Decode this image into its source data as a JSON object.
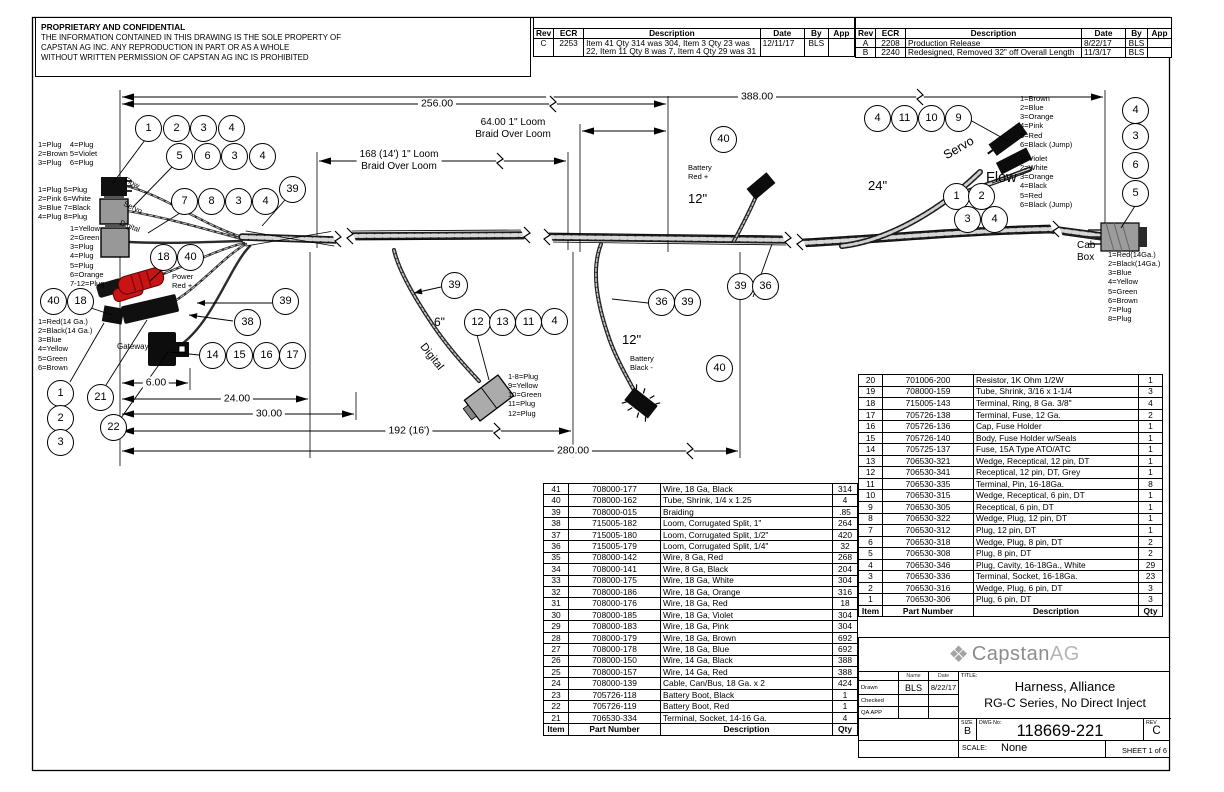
{
  "notice": {
    "title": "PROPRIETARY AND CONFIDENTIAL",
    "line1": "THE INFORMATION CONTAINED IN THIS DRAWING IS THE SOLE PROPERTY OF",
    "line2": "CAPSTAN AG INC. ANY REPRODUCTION IN PART OR AS A WHOLE",
    "line3": "WITHOUT WRITTEN PERMISSION OF CAPSTAN AG INC IS PROHIBITED"
  },
  "rev_table_left": {
    "headers": [
      "Rev",
      "ECR",
      "Description",
      "Date",
      "By",
      "App"
    ],
    "rows": [
      [
        "C",
        "2253",
        "Item 41 Qty 314 was 304, Item 3 Qty 23 was 22, Item 11 Qty 8 was 7, Item 4 Qty 29 was 31",
        "12/11/17",
        "BLS",
        ""
      ]
    ]
  },
  "rev_table_right": {
    "headers": [
      "Rev",
      "ECR",
      "Description",
      "Date",
      "By",
      "App"
    ],
    "rows": [
      [
        "A",
        "2208",
        "Production Release",
        "8/22/17",
        "BLS",
        ""
      ],
      [
        "B",
        "2240",
        "Redesigned, Removed 32\" off Overall Length",
        "11/3/17",
        "BLS",
        ""
      ]
    ]
  },
  "bom_left": {
    "headers": [
      "Item",
      "Part Number",
      "Description",
      "Qty"
    ],
    "rows": [
      [
        "41",
        "708000-177",
        "Wire, 18 Ga, Black",
        "314"
      ],
      [
        "40",
        "708000-162",
        "Tube, Shrink, 1/4 x 1.25",
        "4"
      ],
      [
        "39",
        "708000-015",
        "Braiding",
        ".85"
      ],
      [
        "38",
        "715005-182",
        "Loom, Corrugated Split, 1\"",
        "264"
      ],
      [
        "37",
        "715005-180",
        "Loom, Corrugated Split, 1/2\"",
        "420"
      ],
      [
        "36",
        "715005-179",
        "Loom, Corrugated Split, 1/4\"",
        "32"
      ],
      [
        "35",
        "708000-142",
        "Wire, 8 Ga, Red",
        "268"
      ],
      [
        "34",
        "708000-141",
        "Wire, 8 Ga, Black",
        "204"
      ],
      [
        "33",
        "708000-175",
        "Wire, 18 Ga, White",
        "304"
      ],
      [
        "32",
        "708000-186",
        "Wire, 18 Ga, Orange",
        "316"
      ],
      [
        "31",
        "708000-176",
        "Wire, 18 Ga, Red",
        "18"
      ],
      [
        "30",
        "708000-185",
        "Wire, 18 Ga, Violet",
        "304"
      ],
      [
        "29",
        "708000-183",
        "Wire, 18 Ga, Pink",
        "304"
      ],
      [
        "28",
        "708000-179",
        "Wire, 18 Ga, Brown",
        "692"
      ],
      [
        "27",
        "708000-178",
        "Wire, 18 Ga, Blue",
        "692"
      ],
      [
        "26",
        "708000-150",
        "Wire, 14 Ga, Black",
        "388"
      ],
      [
        "25",
        "708000-157",
        "Wire, 14 Ga, Red",
        "388"
      ],
      [
        "24",
        "708000-139",
        "Cable, Can/Bus, 18 Ga. x 2",
        "424"
      ],
      [
        "23",
        "705726-118",
        "Battery Boot, Black",
        "1"
      ],
      [
        "22",
        "705726-119",
        "Battery Boot, Red",
        "1"
      ],
      [
        "21",
        "706530-334",
        "Terminal, Socket, 14-16 Ga.",
        "4"
      ]
    ]
  },
  "bom_right": {
    "headers": [
      "Item",
      "Part Number",
      "Description",
      "Qty"
    ],
    "rows": [
      [
        "20",
        "701006-200",
        "Resistor, 1K Ohm 1/2W",
        "1"
      ],
      [
        "19",
        "708000-159",
        "Tube, Shrink, 3/16 x 1-1/4",
        "3"
      ],
      [
        "18",
        "715005-143",
        "Terminal, Ring, 8 Ga. 3/8\"",
        "4"
      ],
      [
        "17",
        "705726-138",
        "Terminal, Fuse, 12 Ga.",
        "2"
      ],
      [
        "16",
        "705726-136",
        "Cap, Fuse Holder",
        "1"
      ],
      [
        "15",
        "705726-140",
        "Body, Fuse Holder w/Seals",
        "1"
      ],
      [
        "14",
        "705725-137",
        "Fuse, 15A Type ATO/ATC",
        "1"
      ],
      [
        "13",
        "706530-321",
        "Wedge, Receptical, 12 pin, DT",
        "1"
      ],
      [
        "12",
        "706530-341",
        "Receptical, 12 pin, DT, Grey",
        "1"
      ],
      [
        "11",
        "706530-335",
        "Terminal, Pin, 16-18Ga.",
        "8"
      ],
      [
        "10",
        "706530-315",
        "Wedge, Receptical, 6 pin, DT",
        "1"
      ],
      [
        "9",
        "706530-305",
        "Receptical, 6 pin, DT",
        "1"
      ],
      [
        "8",
        "706530-322",
        "Wedge, Plug, 12 pin, DT",
        "1"
      ],
      [
        "7",
        "706530-312",
        "Plug, 12 pin, DT",
        "1"
      ],
      [
        "6",
        "706530-318",
        "Wedge, Plug, 8 pin, DT",
        "2"
      ],
      [
        "5",
        "706530-308",
        "Plug, 8 pin, DT",
        "2"
      ],
      [
        "4",
        "706530-346",
        "Plug, Cavity, 16-18Ga., White",
        "29"
      ],
      [
        "3",
        "706530-336",
        "Terminal, Socket, 16-18Ga.",
        "23"
      ],
      [
        "2",
        "706530-316",
        "Wedge, Plug, 6 pin, DT",
        "3"
      ],
      [
        "1",
        "706530-306",
        "Plug, 6 pin, DT",
        "3"
      ]
    ]
  },
  "title_block": {
    "company_prefix": "Capstan",
    "company_suffix": "AG",
    "logo_icon": "diamond-checker-icon",
    "name_col": "Name",
    "date_col": "Date",
    "drawn_label": "Drawn",
    "checked_label": "Checked",
    "qa_label": "QA APP",
    "drawn_by": "BLS",
    "drawn_date": "8/22/17",
    "title_label": "TITLE:",
    "title1": "Harness, Alliance",
    "title2": "RG-C Series, No Direct Inject",
    "size_label": "SIZE",
    "size": "B",
    "dwg_label": "DWG No:",
    "dwg_no": "118669-221",
    "rev_label": "REV",
    "rev": "C",
    "scale_label": "SCALE:",
    "scale": "None",
    "sheet": "SHEET 1 of 6"
  },
  "balloons": [
    {
      "n": "1",
      "x": 148,
      "y": 128
    },
    {
      "n": "2",
      "x": 176,
      "y": 128
    },
    {
      "n": "3",
      "x": 203,
      "y": 128
    },
    {
      "n": "4",
      "x": 231,
      "y": 128
    },
    {
      "n": "5",
      "x": 179,
      "y": 156
    },
    {
      "n": "6",
      "x": 207,
      "y": 156
    },
    {
      "n": "3",
      "x": 234,
      "y": 156
    },
    {
      "n": "4",
      "x": 262,
      "y": 156
    },
    {
      "n": "7",
      "x": 184,
      "y": 201
    },
    {
      "n": "8",
      "x": 211,
      "y": 201
    },
    {
      "n": "3",
      "x": 238,
      "y": 201
    },
    {
      "n": "4",
      "x": 265,
      "y": 201
    },
    {
      "n": "39",
      "x": 292,
      "y": 189
    },
    {
      "n": "18",
      "x": 163,
      "y": 257
    },
    {
      "n": "40",
      "x": 190,
      "y": 257
    },
    {
      "n": "40",
      "x": 53,
      "y": 301
    },
    {
      "n": "18",
      "x": 80,
      "y": 301
    },
    {
      "n": "39",
      "x": 285,
      "y": 301
    },
    {
      "n": "38",
      "x": 247,
      "y": 322
    },
    {
      "n": "14",
      "x": 212,
      "y": 355
    },
    {
      "n": "15",
      "x": 239,
      "y": 355
    },
    {
      "n": "16",
      "x": 266,
      "y": 355
    },
    {
      "n": "17",
      "x": 292,
      "y": 355
    },
    {
      "n": "1",
      "x": 60,
      "y": 393
    },
    {
      "n": "21",
      "x": 100,
      "y": 397
    },
    {
      "n": "2",
      "x": 60,
      "y": 418
    },
    {
      "n": "22",
      "x": 113,
      "y": 427
    },
    {
      "n": "3",
      "x": 60,
      "y": 442
    },
    {
      "n": "39",
      "x": 454,
      "y": 285
    },
    {
      "n": "12",
      "x": 477,
      "y": 322
    },
    {
      "n": "13",
      "x": 502,
      "y": 322
    },
    {
      "n": "11",
      "x": 528,
      "y": 322
    },
    {
      "n": "4",
      "x": 554,
      "y": 321
    },
    {
      "n": "36",
      "x": 661,
      "y": 302
    },
    {
      "n": "39",
      "x": 687,
      "y": 302
    },
    {
      "n": "39",
      "x": 740,
      "y": 286
    },
    {
      "n": "36",
      "x": 765,
      "y": 286
    },
    {
      "n": "40",
      "x": 719,
      "y": 368
    },
    {
      "n": "40",
      "x": 723,
      "y": 139
    },
    {
      "n": "4",
      "x": 877,
      "y": 118
    },
    {
      "n": "11",
      "x": 904,
      "y": 118
    },
    {
      "n": "10",
      "x": 931,
      "y": 118
    },
    {
      "n": "9",
      "x": 958,
      "y": 118
    },
    {
      "n": "1",
      "x": 956,
      "y": 196
    },
    {
      "n": "2",
      "x": 981,
      "y": 196
    },
    {
      "n": "3",
      "x": 967,
      "y": 219
    },
    {
      "n": "4",
      "x": 994,
      "y": 219
    },
    {
      "n": "4",
      "x": 1135,
      "y": 110
    },
    {
      "n": "3",
      "x": 1135,
      "y": 136
    },
    {
      "n": "6",
      "x": 1135,
      "y": 165
    },
    {
      "n": "5",
      "x": 1135,
      "y": 193
    }
  ],
  "labels": [
    {
      "name": "pin-table-flow-left",
      "t": "1=Plug    4=Plug\n2=Brown 5=Violet\n3=Plug    6=Plug",
      "x": 38,
      "y": 140,
      "fs": 7.5
    },
    {
      "name": "pin-table-servo-left",
      "t": "1=Plug 5=Plug\n2=Pink 6=White\n3=Blue 7=Black\n4=Plug 8=Plug",
      "x": 38,
      "y": 185,
      "fs": 7.5
    },
    {
      "name": "pin-table-digital-left",
      "t": "1=Yellow\n2=Green\n3=Plug\n4=Plug\n5=Plug\n6=Orange\n7-12=Plug",
      "x": 70,
      "y": 224,
      "fs": 7.5
    },
    {
      "name": "pin-table-power-left",
      "t": "1=Red(14 Ga.)\n2=Black(14 Ga.)\n3=Blue\n4=Yellow\n5=Green\n6=Brown",
      "x": 38,
      "y": 317,
      "fs": 7.5
    },
    {
      "name": "label-gateway",
      "t": "Gateway",
      "x": 117,
      "y": 342,
      "fs": 8
    },
    {
      "name": "label-power-red",
      "t": "Power\nRed +",
      "x": 172,
      "y": 272,
      "fs": 7.5
    },
    {
      "name": "label-flow-cable",
      "t": "Flow",
      "x": 127,
      "y": 175,
      "fs": 7.5,
      "rot": 27
    },
    {
      "name": "label-servo-cable",
      "t": "Servo",
      "x": 126,
      "y": 199,
      "fs": 7.5,
      "rot": 25
    },
    {
      "name": "label-digital-cable",
      "t": "Digital",
      "x": 122,
      "y": 218,
      "fs": 7.5,
      "rot": 22
    },
    {
      "name": "label-6in",
      "t": "6\"",
      "x": 434,
      "y": 315,
      "fs": 12
    },
    {
      "name": "label-digital-branch",
      "t": "Digital",
      "x": 427,
      "y": 341,
      "fs": 11,
      "rot": 52
    },
    {
      "name": "pin-table-digital-conn",
      "t": "1-8=Plug\n9=Yellow\n10=Green\n11=Plug\n12=Plug",
      "x": 508,
      "y": 372,
      "fs": 7.5
    },
    {
      "name": "label-12in-black",
      "t": "12\"",
      "x": 622,
      "y": 332,
      "fs": 13
    },
    {
      "name": "label-battery-black",
      "t": "Battery\nBlack -",
      "x": 630,
      "y": 354,
      "fs": 7.5
    },
    {
      "name": "label-battery-red",
      "t": "Battery\nRed +",
      "x": 688,
      "y": 163,
      "fs": 7.5
    },
    {
      "name": "label-12in-red",
      "t": "12\"",
      "x": 688,
      "y": 191,
      "fs": 13
    },
    {
      "name": "label-24in",
      "t": "24\"",
      "x": 868,
      "y": 178,
      "fs": 13
    },
    {
      "name": "label-servo-branch",
      "t": "Servo",
      "x": 941,
      "y": 150,
      "fs": 12.5,
      "rot": -30
    },
    {
      "name": "label-flow-branch",
      "t": "Flow",
      "x": 986,
      "y": 170,
      "fs": 14.5
    },
    {
      "name": "pin-table-servo-conn",
      "t": "1=Brown\n2=Blue\n3=Orange\n4=Pink\n5=Red\n6=Black (Jump)",
      "x": 1020,
      "y": 94,
      "fs": 7.5
    },
    {
      "name": "pin-table-flow-conn",
      "t": "1=Violet\n2=White\n3=Orange\n4=Black\n5=Red\n6=Black (Jump)",
      "x": 1020,
      "y": 154,
      "fs": 7.5
    },
    {
      "name": "label-cab-box",
      "t": "Cab\nBox",
      "x": 1077,
      "y": 240,
      "fs": 10
    },
    {
      "name": "pin-table-cab",
      "t": "1=Red(14Ga.)\n2=Black(14Ga.)\n3=Blue\n4=Yellow\n5=Green\n6=Brown\n7=Plug\n8=Plug",
      "x": 1108,
      "y": 250,
      "fs": 7.5
    },
    {
      "name": "dim-388",
      "t": "388.00",
      "x": 757,
      "y": 97,
      "fs": 10.5,
      "ctr": true,
      "bg": true
    },
    {
      "name": "dim-256",
      "t": "256.00",
      "x": 437,
      "y": 104,
      "fs": 10.5,
      "ctr": true,
      "bg": true
    },
    {
      "name": "dim-64-loom",
      "t": "64.00 1\" Loom\nBraid Over Loom",
      "x": 513,
      "y": 129,
      "fs": 10,
      "ctr": true,
      "bg": true
    },
    {
      "name": "dim-168-loom",
      "t": "168 (14') 1\" Loom\nBraid Over Loom",
      "x": 399,
      "y": 161,
      "fs": 10,
      "ctr": true,
      "bg": true
    },
    {
      "name": "dim-6",
      "t": "6.00",
      "x": 156,
      "y": 383,
      "fs": 10.5,
      "ctr": true,
      "bg": true
    },
    {
      "name": "dim-24",
      "t": "24.00",
      "x": 237,
      "y": 399,
      "fs": 10.5,
      "ctr": true,
      "bg": true
    },
    {
      "name": "dim-30",
      "t": "30.00",
      "x": 269,
      "y": 414,
      "fs": 10.5,
      "ctr": true,
      "bg": true
    },
    {
      "name": "dim-192",
      "t": "192 (16')",
      "x": 409,
      "y": 431,
      "fs": 10.5,
      "ctr": true,
      "bg": true
    },
    {
      "name": "dim-280",
      "t": "280.00",
      "x": 573,
      "y": 451,
      "fs": 10.5,
      "ctr": true,
      "bg": true
    }
  ]
}
